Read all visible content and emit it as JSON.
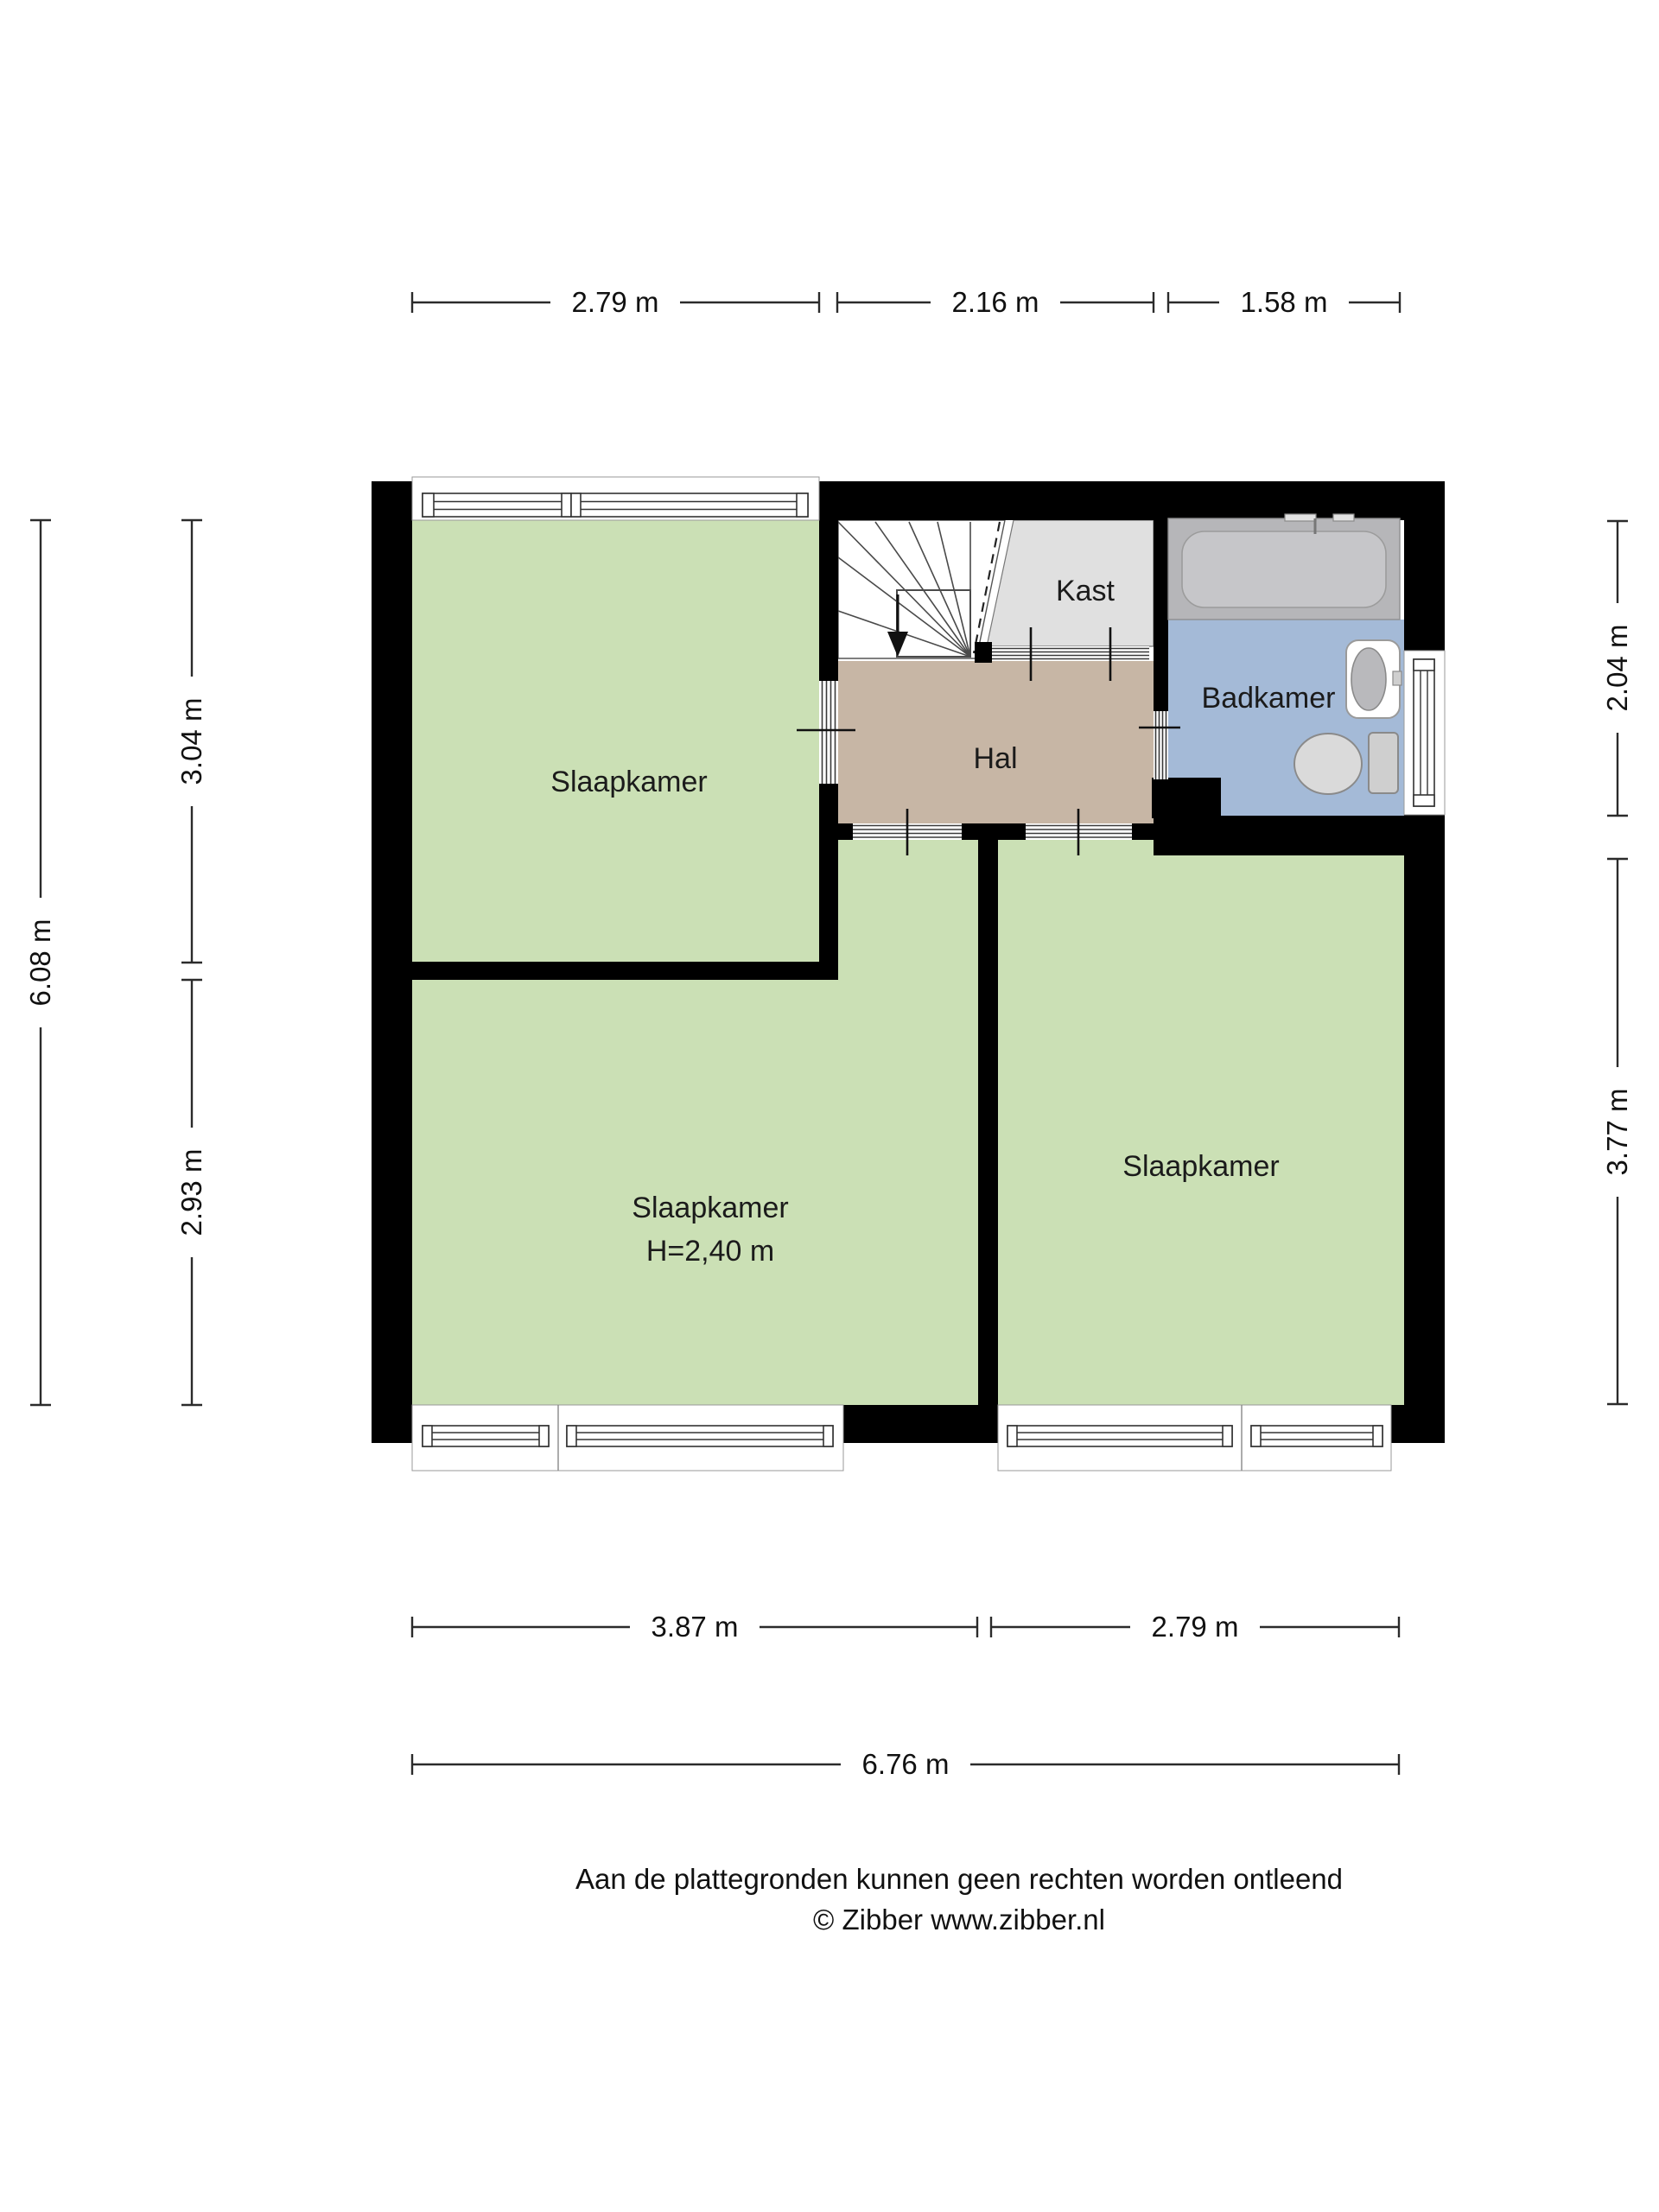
{
  "rooms": {
    "bedroom_top_left": {
      "label": "Slaapkamer"
    },
    "bedroom_bottom_left": {
      "label": "Slaapkamer",
      "height": "H=2,40 m"
    },
    "bedroom_bottom_right": {
      "label": "Slaapkamer"
    },
    "hall": {
      "label": "Hal"
    },
    "closet": {
      "label": "Kast"
    },
    "bathroom": {
      "label": "Badkamer"
    }
  },
  "dimensions": {
    "top_left_room": "2.79 m",
    "top_stairs": "2.16 m",
    "top_bathroom": "1.58 m",
    "left_overall": "6.08 m",
    "left_upper": "3.04 m",
    "left_lower": "2.93 m",
    "right_bathroom": "2.04 m",
    "right_bedroom": "3.77 m",
    "bottom_left_room": "3.87 m",
    "bottom_right_room": "2.79 m",
    "bottom_overall": "6.76 m"
  },
  "footer": {
    "line1": "Aan de plattegronden kunnen geen rechten worden ontleend",
    "line2": "© Zibber www.zibber.nl"
  },
  "colors": {
    "wall_black": "#000000",
    "room_green": "#cbe0b5",
    "hall_tan": "#c7b6a5",
    "closet_gray": "#e0e0e0",
    "bathroom_blue": "#a4bad7",
    "tub_deck": "#b6b6b9",
    "tub_inner": "#c6c6c9",
    "fixture_gray": "#d6d6d8"
  }
}
